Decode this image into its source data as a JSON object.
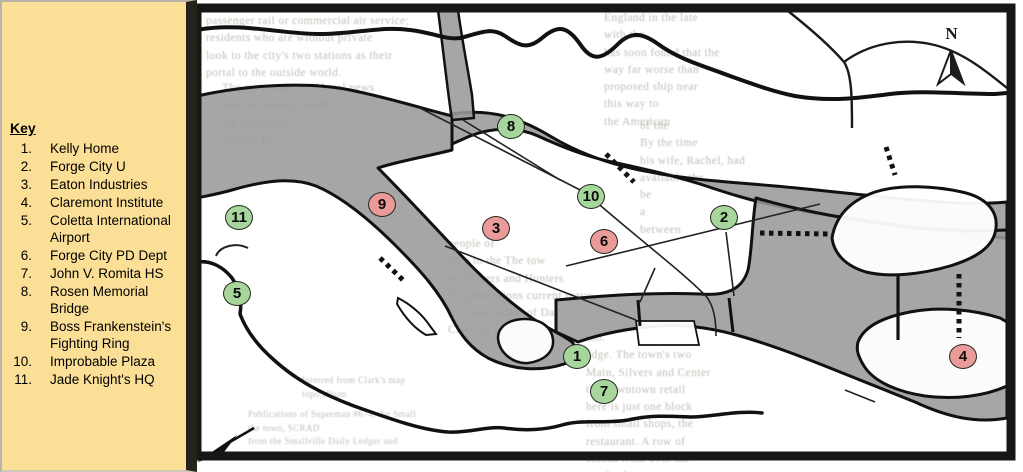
{
  "key": {
    "title": "Key",
    "items": [
      {
        "num": "1.",
        "label": "Kelly Home"
      },
      {
        "num": "2.",
        "label": "Forge City U"
      },
      {
        "num": "3.",
        "label": "Eaton Industries"
      },
      {
        "num": "4.",
        "label": "Claremont Institute"
      },
      {
        "num": "5.",
        "label": "Coletta International Airport"
      },
      {
        "num": "6.",
        "label": "Forge City PD Dept"
      },
      {
        "num": "7.",
        "label": "John V. Romita HS"
      },
      {
        "num": "8.",
        "label": "Rosen Memorial Bridge"
      },
      {
        "num": "9.",
        "label": "Boss Frankenstein's Fighting Ring"
      },
      {
        "num": "10.",
        "label": "Improbable Plaza"
      },
      {
        "num": "11.",
        "label": "Jade Knight's HQ"
      }
    ]
  },
  "map": {
    "compass_label": "N",
    "colors": {
      "marker_green": "#a7d69c",
      "marker_red": "#ea9a99",
      "water_gray": "#9a9a9a",
      "key_bg": "#fbdf96",
      "ink": "#141414"
    },
    "markers": [
      {
        "label": "1",
        "color": "green",
        "x": 577,
        "y": 356,
        "location": "Kelly Home"
      },
      {
        "label": "2",
        "color": "green",
        "x": 724,
        "y": 217,
        "location": "Forge City U"
      },
      {
        "label": "3",
        "color": "red",
        "x": 496,
        "y": 228,
        "location": "Eaton Industries"
      },
      {
        "label": "4",
        "color": "red",
        "x": 963,
        "y": 356,
        "location": "Claremont Institute"
      },
      {
        "label": "5",
        "color": "green",
        "x": 237,
        "y": 293,
        "location": "Coletta International Airport"
      },
      {
        "label": "6",
        "color": "red",
        "x": 604,
        "y": 241,
        "location": "Forge City PD Dept"
      },
      {
        "label": "7",
        "color": "green",
        "x": 604,
        "y": 391,
        "location": "John V. Romita HS"
      },
      {
        "label": "8",
        "color": "green",
        "x": 511,
        "y": 126,
        "location": "Rosen Memorial Bridge"
      },
      {
        "label": "9",
        "color": "red",
        "x": 382,
        "y": 204,
        "location": "Boss Frankenstein's Fighting Ring"
      },
      {
        "label": "10",
        "color": "green",
        "x": 591,
        "y": 196,
        "location": "Improbable Plaza"
      },
      {
        "label": "11",
        "color": "green",
        "x": 239,
        "y": 217,
        "location": "Jade Knight's HQ"
      }
    ],
    "ghost_text": [
      {
        "x": 206,
        "y": 13,
        "w": 258,
        "size": 11.5,
        "lines": [
          "passenger rail or commercial air service;",
          "residents who are without private",
          "look to the city's two stations as their",
          "portal to the outside world."
        ]
      },
      {
        "x": 222,
        "y": 80,
        "w": 250,
        "size": 11.5,
        "lines": [
          "The main source of local news",
          "and the weekly Small",
          "the Smallville",
          "County Re"
        ]
      },
      {
        "x": 604,
        "y": 10,
        "w": 190,
        "size": 11.5,
        "lines": [
          "England in the late",
          "with the",
          "has soon found that the",
          "way far worse than",
          "proposed ship near",
          "this way to",
          "the American"
        ]
      },
      {
        "x": 640,
        "y": 118,
        "w": 170,
        "size": 11.5,
        "lines": [
          "of the",
          "By the time",
          "his wife, Rachel, had",
          "available the",
          "be",
          "a",
          "between"
        ]
      },
      {
        "x": 448,
        "y": 236,
        "w": 200,
        "size": 11.5,
        "lines": [
          "people of",
          "Jeep to the          The tow",
          "by Olivers          and Hunters",
          "for generations          current mayo",
          "is a          descendant of Da",
          "Clark, is a common"
        ]
      },
      {
        "x": 586,
        "y": 330,
        "w": 185,
        "size": 11.5,
        "lines": [
          "too.",
          "edge. The town's two",
          "Main, Silvers and Center",
          "the downtown retail",
          "here is just one block",
          "from small shops, the",
          "restaurant. A row of",
          "blocks from over the",
          "south of town is"
        ]
      },
      {
        "x": 302,
        "y": 374,
        "w": 150,
        "size": 9,
        "lines": [
          "Interred from Clark's map",
          "topo album"
        ]
      },
      {
        "x": 248,
        "y": 408,
        "w": 235,
        "size": 9,
        "lines": [
          "Publications of Superman #674, the Small",
          "the town, SCRAD",
          "from the Smallville Daily Ledger and",
          "appears in Mr. Kent's youth section"
        ]
      }
    ]
  }
}
